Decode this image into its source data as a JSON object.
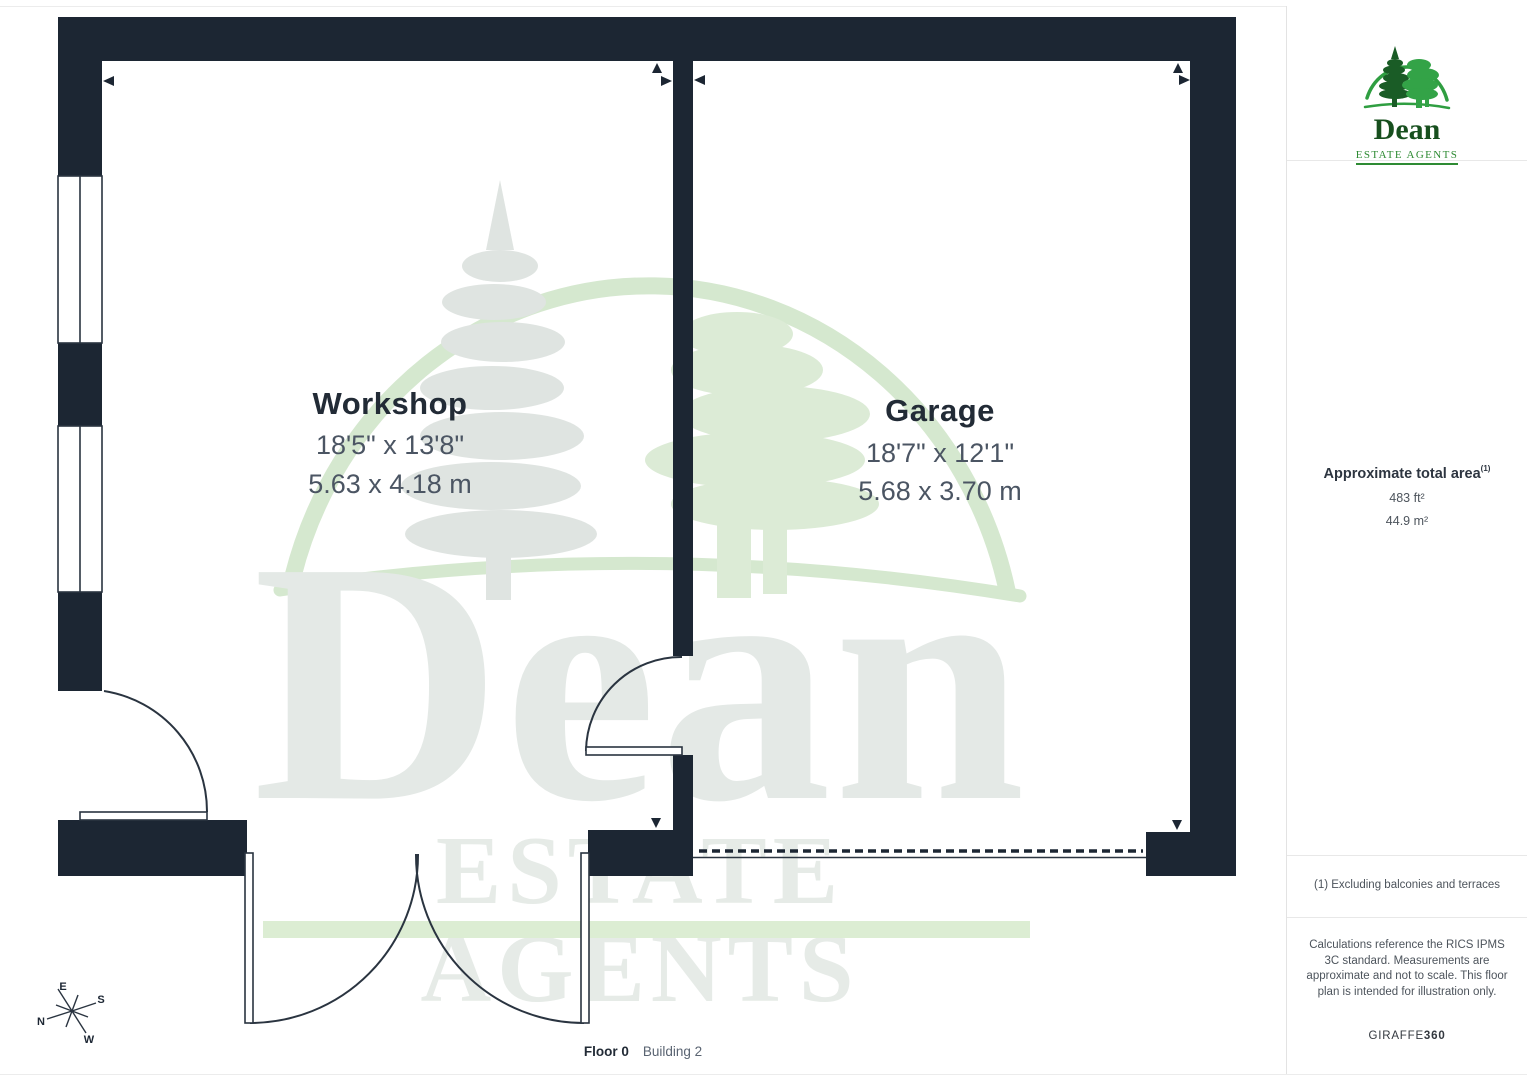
{
  "brand": {
    "name": "Dean",
    "subtitle": "ESTATE AGENTS"
  },
  "watermark": {
    "name": "Dean",
    "subtitle": "ESTATE AGENTS"
  },
  "rooms": [
    {
      "name": "Workshop",
      "dimensions_imperial": "18'5\" x 13'8\"",
      "dimensions_metric": "5.63 x 4.18 m"
    },
    {
      "name": "Garage",
      "dimensions_imperial": "18'7\" x 12'1\"",
      "dimensions_metric": "5.68 x 3.70 m"
    }
  ],
  "sidebar": {
    "area_title": "Approximate total area",
    "area_footnote_marker": "(1)",
    "area_imperial": "483 ft²",
    "area_metric": "44.9 m²",
    "footnote": "(1) Excluding balconies and terraces",
    "disclaimer": "Calculations reference the RICS IPMS 3C standard. Measurements are approximate and not to scale. This floor plan is intended for illustration only.",
    "provider": "GIRAFFE",
    "provider_suffix": "360"
  },
  "footer": {
    "floor_label": "Floor 0",
    "building_label": "Building 2"
  },
  "compass": {
    "n": "N",
    "e": "E",
    "s": "S",
    "w": "W"
  },
  "colors": {
    "wall": "#1c2633",
    "plan_line": "#2a3440",
    "brand_green": "#2f9e41",
    "brand_dark_green": "#174f1e",
    "watermark_text": "#e4e9e6",
    "watermark_band": "#dcedd3",
    "text_dark": "#222b36",
    "text_dim": "#4b5563",
    "text_muted": "#4d545c",
    "divider": "#e8e8e8"
  }
}
